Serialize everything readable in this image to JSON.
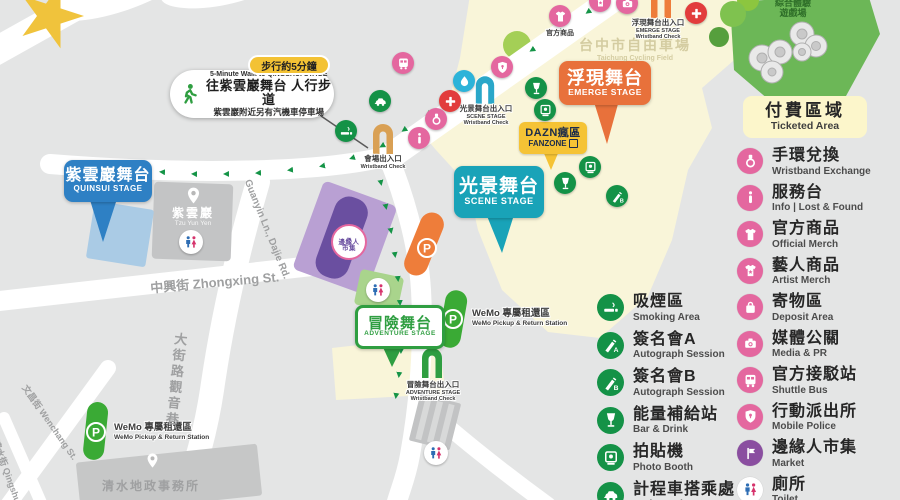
{
  "walk_callout": {
    "badge": "步行約5分鐘",
    "en": "5-Minute Walk to QINGSHUI STAGE",
    "title": "往紫雲巖舞台 人行步道",
    "note": "紫雲巖附近另有汽機車停車場"
  },
  "stages": {
    "quinsui": {
      "zh": "紫雲巖舞台",
      "en": "QUINSUI STAGE"
    },
    "adventure": {
      "zh": "冒險舞台",
      "en": "ADVENTURE STAGE"
    },
    "scene": {
      "zh": "光景舞台",
      "en": "SCENE STAGE"
    },
    "emerge": {
      "zh": "浮現舞台",
      "en": "EMERGE STAGE"
    },
    "fanzone": {
      "zh": "DAZN瘋區",
      "en": "FANZONE"
    }
  },
  "entrances": {
    "venue": {
      "zh": "會場出入口",
      "check": "Wristband Check"
    },
    "scene": {
      "zh": "光景舞台出入口",
      "stage": "SCENE STAGE",
      "check": "Wristband Check"
    },
    "emerge": {
      "zh": "浮現舞台出入口",
      "stage": "EMERGE STAGE",
      "check": "Wristband Check"
    },
    "adventure": {
      "zh": "冒險舞台出入口",
      "stage": "ADVENTURE STAGE",
      "check": "Wristband Check"
    }
  },
  "places": {
    "cycling": {
      "zh": "台中市自由車場",
      "en": "Taichung Cycling Field"
    },
    "playground": {
      "l1": "綜合體驗",
      "l2": "遊戲場"
    },
    "temple": {
      "zh": "紫雲巖",
      "en": "Tzu Yun Yen"
    },
    "office": {
      "zh": "清水地政事務所"
    },
    "market": {
      "l1": "邊緣人",
      "l2": "市集"
    },
    "merch": "官方商品"
  },
  "streets": {
    "zhongxing": "中興街 Zhongxing St.",
    "guanyin": "Guanyin Ln., Dajie Rd.",
    "dajie": "大街路觀音巷",
    "wenchang": "文昌街 Wenchang St.",
    "qingshui": "清水街 Qingshui St."
  },
  "wemo": {
    "zh": "WeMo 專屬租還區",
    "en": "WeMo Pickup & Return Station"
  },
  "legend": {
    "ticketed": {
      "zh": "付費區域",
      "en": "Ticketed Area"
    },
    "green_items": [
      {
        "zh": "吸煙區",
        "en": "Smoking Area",
        "icon": "smoking",
        "color": "#149247"
      },
      {
        "zh": "簽名會A",
        "en": "Autograph Session",
        "icon": "pen-a",
        "color": "#149247"
      },
      {
        "zh": "簽名會B",
        "en": "Autograph Session",
        "icon": "pen-b",
        "color": "#149247"
      },
      {
        "zh": "能量補給站",
        "en": "Bar & Drink",
        "icon": "goblet",
        "color": "#149247"
      },
      {
        "zh": "拍貼機",
        "en": "Photo Booth",
        "icon": "photobooth",
        "color": "#149247"
      },
      {
        "zh": "計程車搭乘處",
        "en": "Taxi Stand",
        "icon": "taxi",
        "color": "#149247"
      }
    ],
    "pink_items": [
      {
        "zh": "手環兌換",
        "en": "Wristband Exchange",
        "icon": "wristband",
        "color": "#e4679f"
      },
      {
        "zh": "服務台",
        "en": "Info | Lost & Found",
        "icon": "info",
        "color": "#e4679f"
      },
      {
        "zh": "官方商品",
        "en": "Official Merch",
        "icon": "shirt",
        "color": "#e4679f"
      },
      {
        "zh": "藝人商品",
        "en": "Artist Merch",
        "icon": "shirt-star",
        "color": "#e4679f"
      },
      {
        "zh": "寄物區",
        "en": "Deposit Area",
        "icon": "bag",
        "color": "#e4679f"
      },
      {
        "zh": "媒體公關",
        "en": "Media & PR",
        "icon": "camera",
        "color": "#e4679f"
      },
      {
        "zh": "官方接駁站",
        "en": "Shuttle Bus",
        "icon": "bus",
        "color": "#e4679f"
      },
      {
        "zh": "行動派出所",
        "en": "Mobile Police",
        "icon": "shield",
        "color": "#e4679f"
      },
      {
        "zh": "邊緣人市集",
        "en": "Market",
        "icon": "flag",
        "color": "#8a4ea0"
      },
      {
        "zh": "廁所",
        "en": "Toilet",
        "icon": "toilet",
        "color": "#ffffff"
      }
    ]
  },
  "colors": {
    "pink": "#e4679f",
    "green": "#149247",
    "purple": "#8a4ea0",
    "orange": "#ee7d3a",
    "teal": "#19a3b8",
    "blue": "#2e80c4",
    "badge_yellow": "#f3c234",
    "ticketed_area": "#f9f5d9"
  }
}
